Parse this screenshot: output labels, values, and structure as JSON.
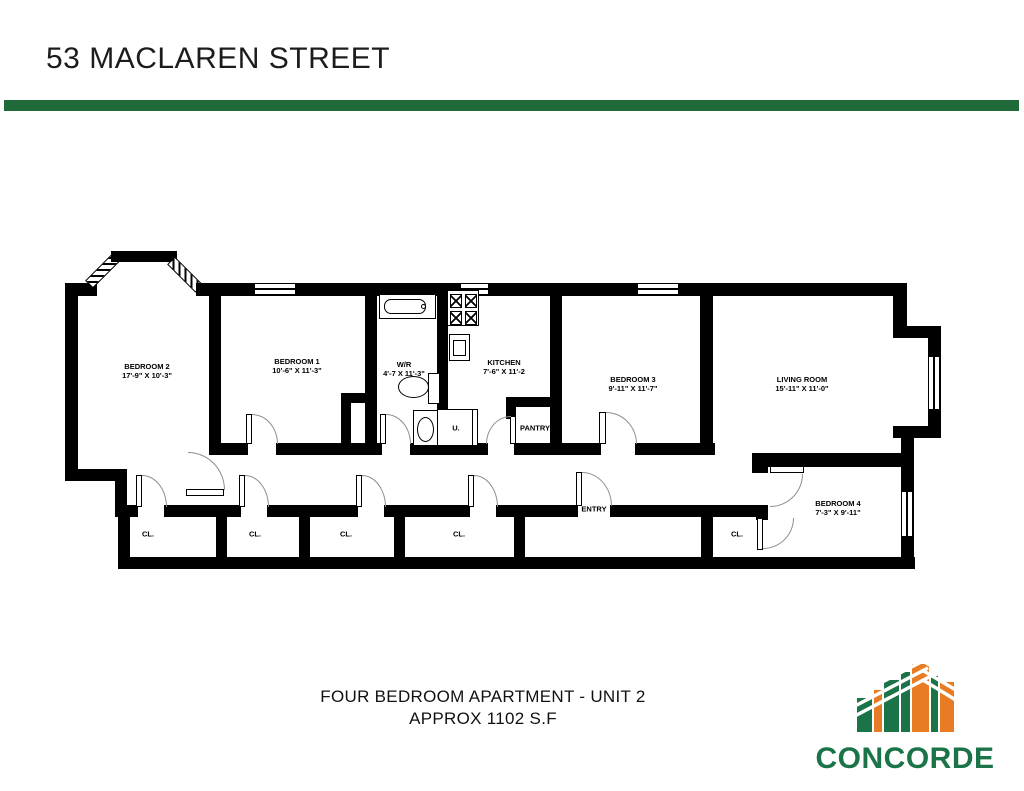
{
  "page": {
    "title": "53 MACLAREN STREET"
  },
  "colors": {
    "divider_green": "#206b39",
    "logo_green": "#1a7448",
    "logo_orange": "#e87c24"
  },
  "rooms": [
    {
      "name": "BEDROOM 2",
      "dims": "17'-9\" X 10'-3\""
    },
    {
      "name": "BEDROOM 1",
      "dims": "10'-6\" X 11'-3\""
    },
    {
      "name": "W/R",
      "dims": "4'-7 X 11'-3\""
    },
    {
      "name": "KITCHEN",
      "dims": "7'-6\" X 11'-2"
    },
    {
      "name": "BEDROOM 3",
      "dims": "9'-11\" X 11'-7\""
    },
    {
      "name": "LIVING ROOM",
      "dims": "15'-11\" X 11'-0\""
    },
    {
      "name": "BEDROOM 4",
      "dims": "7'-3\" X 9'-11\""
    }
  ],
  "labels": {
    "pantry": "PANTRY",
    "entry": "ENTRY",
    "closet": "CL.",
    "utility": "U."
  },
  "footer": {
    "line1": "FOUR BEDROOM APARTMENT - UNIT 2",
    "line2": "APPROX 1102 S.F"
  },
  "logo": {
    "text": "CONCORDE"
  }
}
